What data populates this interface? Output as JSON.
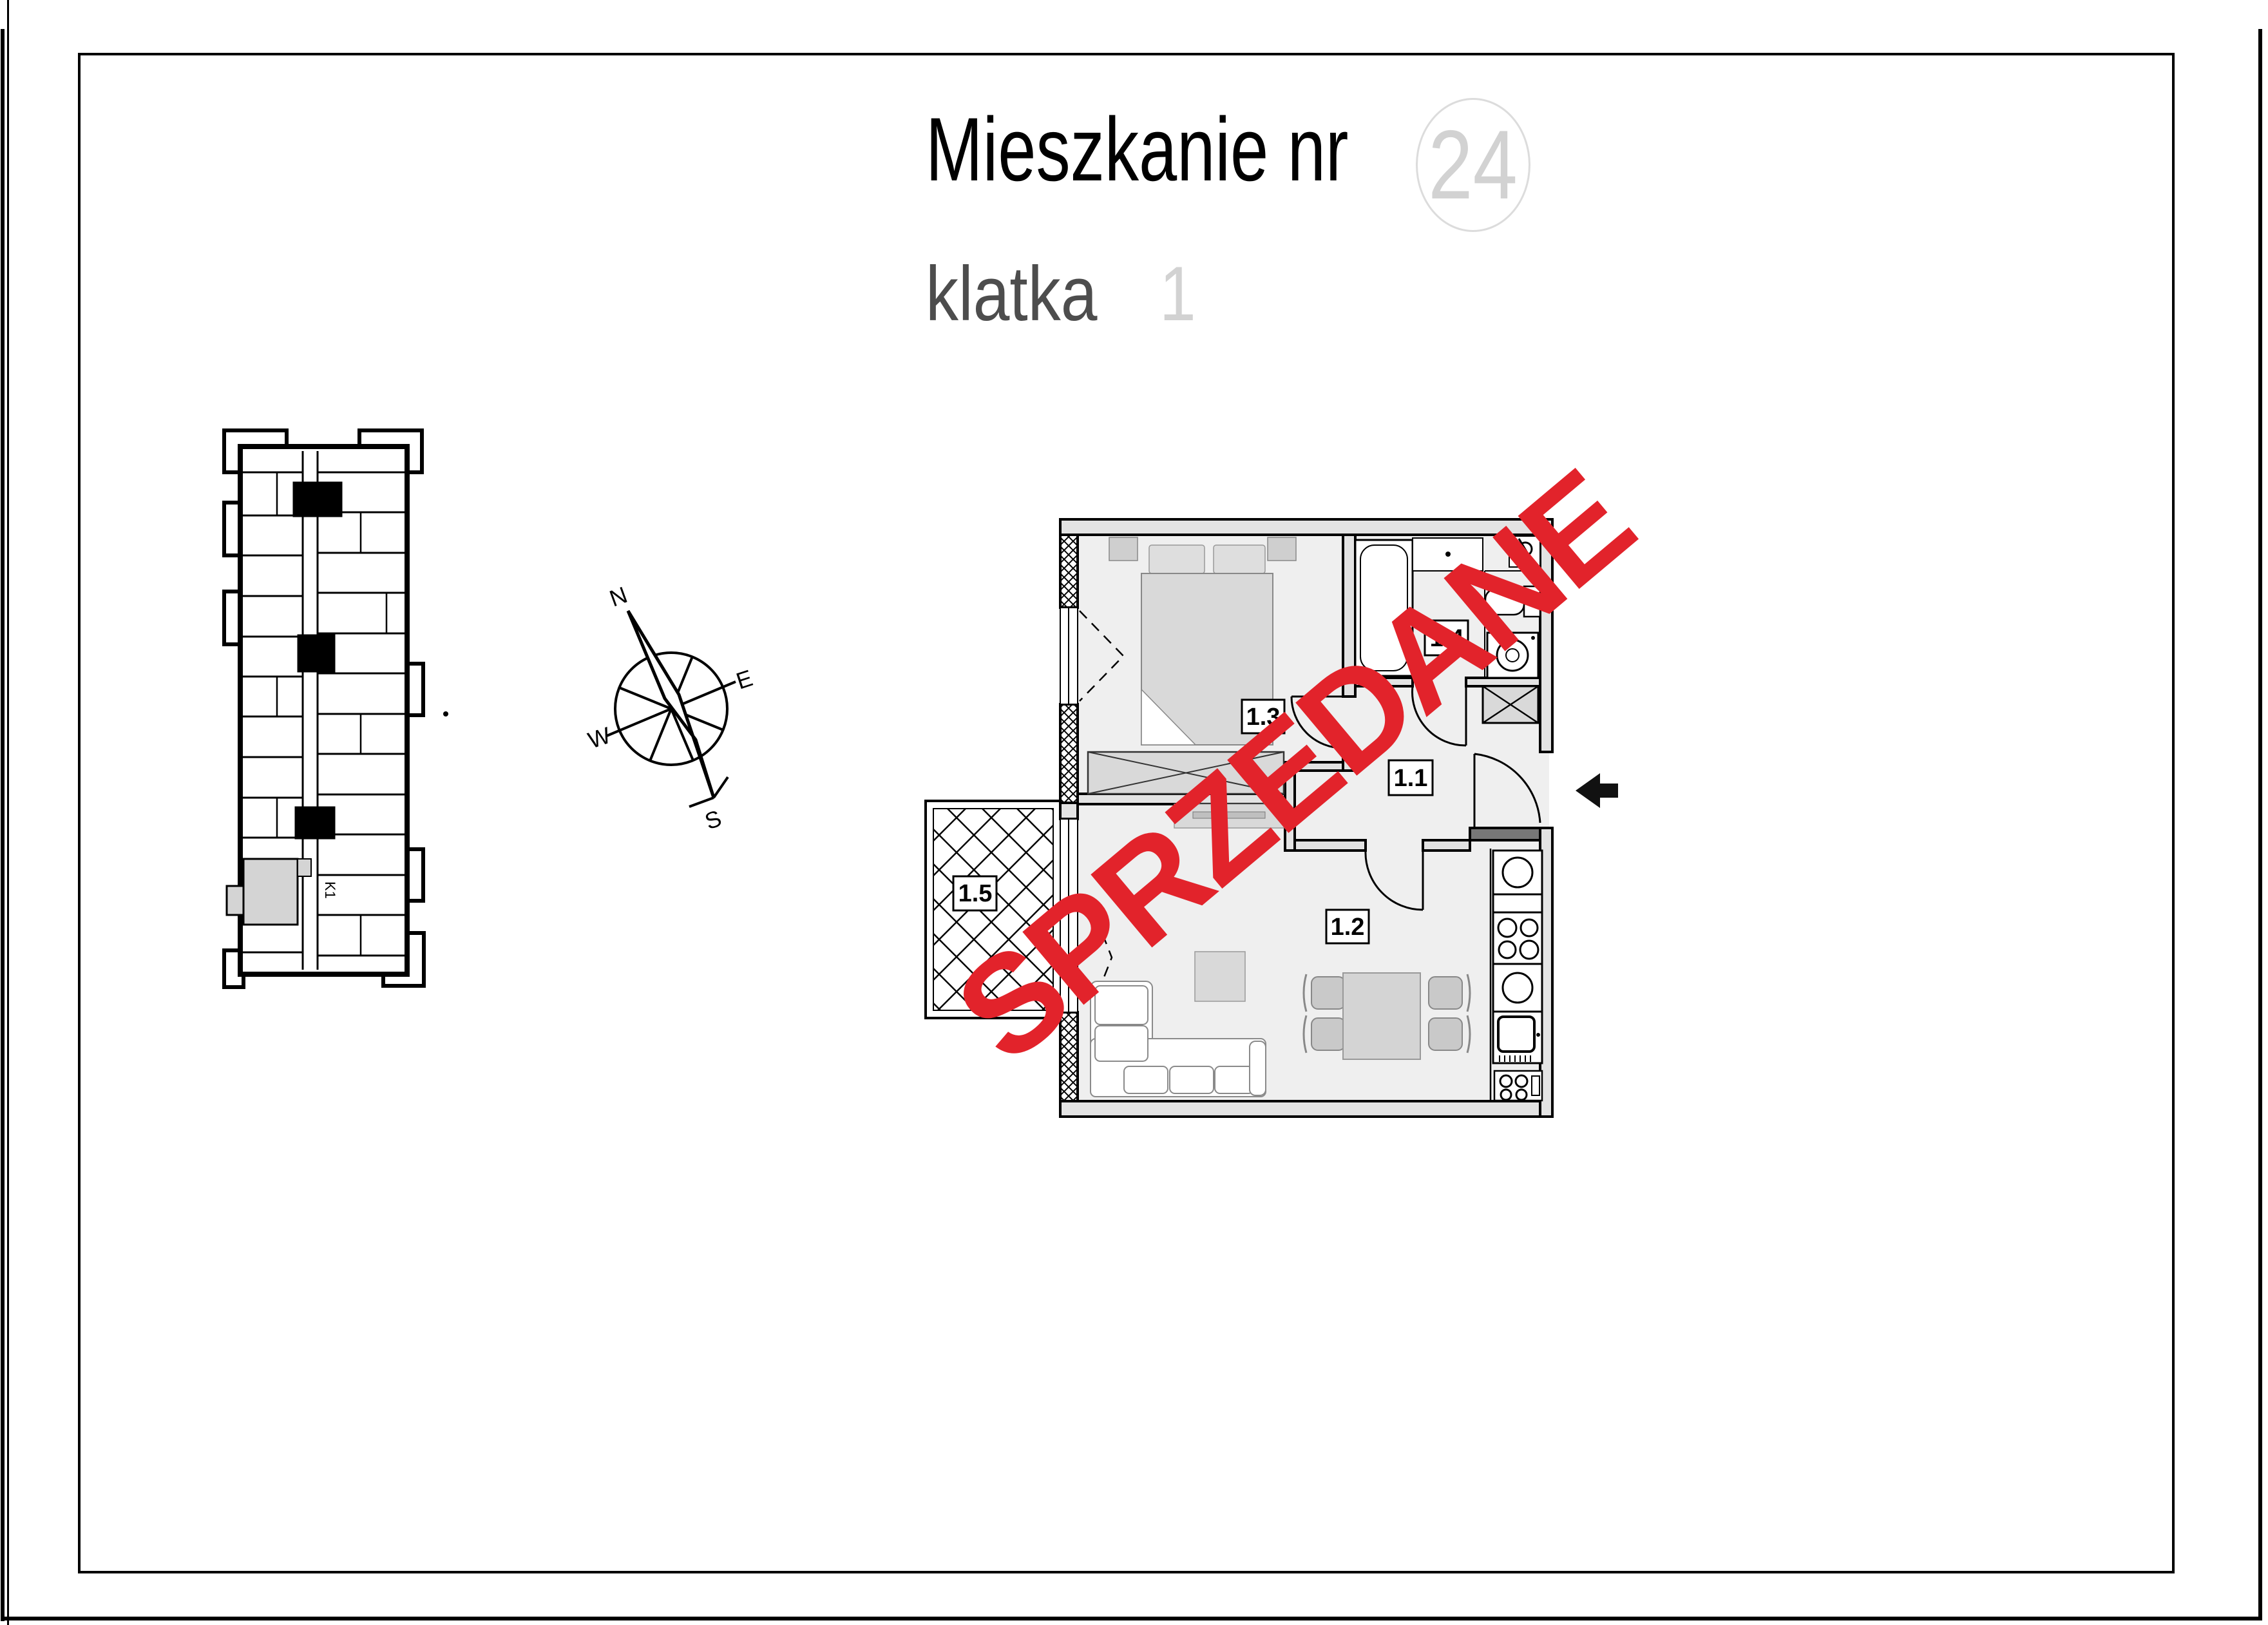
{
  "header": {
    "title_label": "Mieszkanie nr",
    "apartment_number": "24",
    "staircase_label": "klatka",
    "staircase_number": "1"
  },
  "watermark": {
    "text": "SPRZEDANE",
    "color": "#e2232b",
    "rotation_deg": -40
  },
  "compass": {
    "north": "N",
    "east": "E",
    "south": "S",
    "west": "W"
  },
  "site_plan": {
    "core_label": "K1",
    "highlight_color": "#d4d4d4"
  },
  "floor_plan": {
    "rooms": [
      {
        "id": "1.1",
        "name": "hall"
      },
      {
        "id": "1.2",
        "name": "living-room-with-kitchenette"
      },
      {
        "id": "1.3",
        "name": "bedroom"
      },
      {
        "id": "1.4",
        "name": "bathroom"
      },
      {
        "id": "1.5",
        "name": "balcony"
      }
    ],
    "wall_color": "#e3e3e3",
    "room_fill": "#efefef",
    "furniture_fill": "#d9d9d9"
  }
}
